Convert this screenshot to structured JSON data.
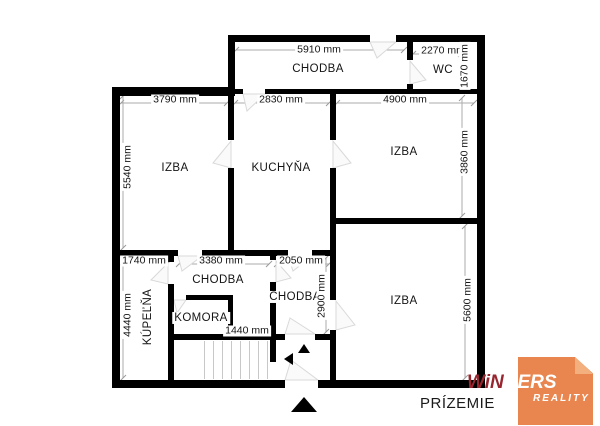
{
  "floor_label": "PRÍZEMIE",
  "colors": {
    "walls": "#000000",
    "dimension_lines": "#ABABAB",
    "logo_orange": "#E9854E",
    "logo_fold": "#F3B07E",
    "logo_dark_red": "#97262F",
    "logo_text_light": "#FFFFFF"
  },
  "rooms": [
    {
      "id": "chodba-top",
      "label": "CHODBA",
      "x": 318,
      "y": 69,
      "vertical": false
    },
    {
      "id": "wc",
      "label": "WC",
      "x": 443,
      "y": 70,
      "vertical": false
    },
    {
      "id": "izba-left",
      "label": "IZBA",
      "x": 175,
      "y": 168,
      "vertical": false
    },
    {
      "id": "kuchyna",
      "label": "KUCHYŇA",
      "x": 281,
      "y": 168,
      "vertical": false
    },
    {
      "id": "izba-right-top",
      "label": "IZBA",
      "x": 404,
      "y": 152,
      "vertical": false
    },
    {
      "id": "chodba-middle",
      "label": "CHODBA",
      "x": 218,
      "y": 280,
      "vertical": false
    },
    {
      "id": "kupelna",
      "label": "KÚPEĽŇA",
      "x": 148,
      "y": 317,
      "vertical": true
    },
    {
      "id": "komora",
      "label": "KOMORA",
      "x": 201,
      "y": 318,
      "vertical": false
    },
    {
      "id": "chodba-right",
      "label": "CHODBA",
      "x": 295,
      "y": 297,
      "vertical": false
    },
    {
      "id": "izba-bottom",
      "label": "IZBA",
      "x": 404,
      "y": 301,
      "vertical": false
    }
  ],
  "dimensions": [
    {
      "label": "5910 mm",
      "x": 319,
      "y": 50,
      "vertical": false
    },
    {
      "label": "2270 mm",
      "x": 443,
      "y": 51,
      "vertical": false
    },
    {
      "label": "1670 mm",
      "x": 465,
      "y": 66,
      "vertical": true
    },
    {
      "label": "3790 mm",
      "x": 175,
      "y": 100,
      "vertical": false
    },
    {
      "label": "2830 mm",
      "x": 281,
      "y": 100,
      "vertical": false
    },
    {
      "label": "4900 mm",
      "x": 405,
      "y": 100,
      "vertical": false
    },
    {
      "label": "5540 mm",
      "x": 128,
      "y": 167,
      "vertical": true
    },
    {
      "label": "3860 mm",
      "x": 465,
      "y": 152,
      "vertical": true
    },
    {
      "label": "1740 mm",
      "x": 144,
      "y": 261,
      "vertical": false
    },
    {
      "label": "3380 mm",
      "x": 221,
      "y": 261,
      "vertical": false
    },
    {
      "label": "2050 mm",
      "x": 301,
      "y": 261,
      "vertical": false
    },
    {
      "label": "2900 mm",
      "x": 322,
      "y": 296,
      "vertical": true
    },
    {
      "label": "4440 mm",
      "x": 128,
      "y": 315,
      "vertical": true
    },
    {
      "label": "1440 mm",
      "x": 247,
      "y": 331,
      "vertical": false
    },
    {
      "label": "5600 mm",
      "x": 468,
      "y": 300,
      "vertical": true
    }
  ],
  "icons": {
    "entrance_arrow": "up-triangle",
    "stairs_up_arrow": "up-triangle",
    "stairs_left_arrow": "left-triangle"
  },
  "logo": {
    "brand_dark": "WiN",
    "brand_light": "NERS",
    "subtitle": "REALITY"
  }
}
